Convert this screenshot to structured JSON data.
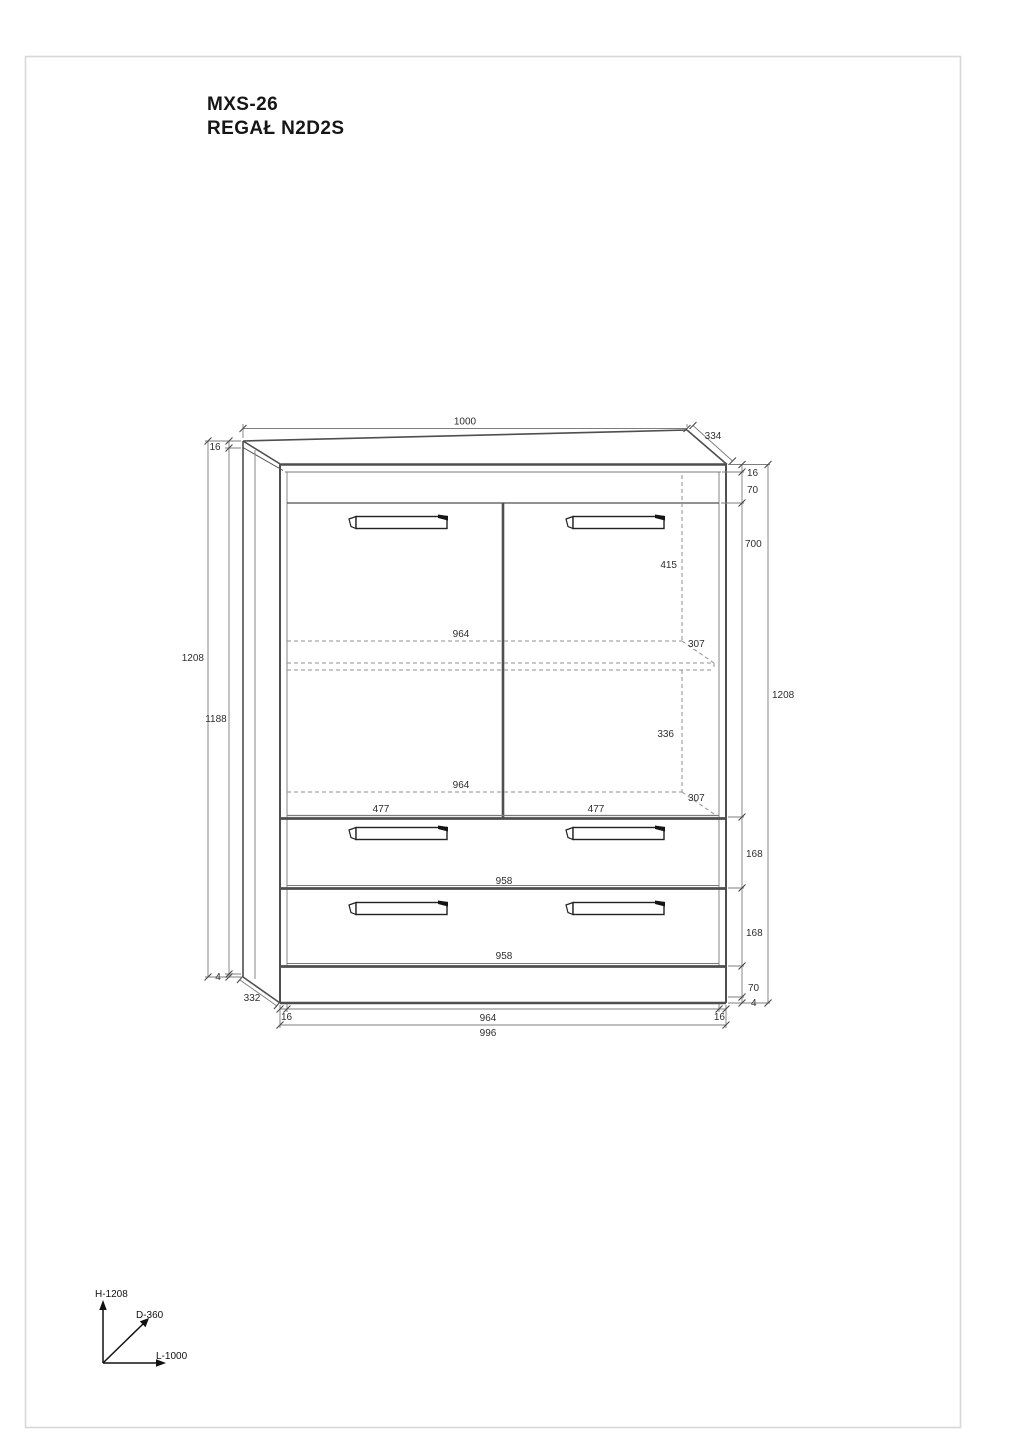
{
  "page": {
    "title_line1": "MXS-26",
    "title_line2": "REGAŁ N2D2S"
  },
  "axis_legend": {
    "height_axis": "H-1208",
    "depth_axis": "D-360",
    "length_axis": "L-1000"
  },
  "dims": {
    "top_width": "1000",
    "top_depth": "334",
    "left_total_height": "1208",
    "left_inner_height": "1188",
    "left_top_thickness": "16",
    "left_bottom_gap": "4",
    "bottom_depth": "332",
    "right_top_thickness": "16",
    "right_top_rail": "70",
    "right_door_height": "700",
    "right_drawer1_height": "168",
    "right_drawer2_height": "168",
    "right_plinth_height": "70",
    "right_bottom_gap": "4",
    "right_total_height": "1208",
    "bottom_left_thickness": "16",
    "bottom_inner_width": "964",
    "bottom_right_thickness": "16",
    "bottom_total_width": "996",
    "shelf_back_width_upper": "964",
    "shelf_depth_upper": "307",
    "shelf_back_width_lower": "964",
    "shelf_depth_lower": "307",
    "space_above_shelf": "415",
    "space_below_shelf": "336",
    "door_width_left": "477",
    "door_width_right": "477",
    "drawer_front_width_1": "958",
    "drawer_front_width_2": "958"
  }
}
